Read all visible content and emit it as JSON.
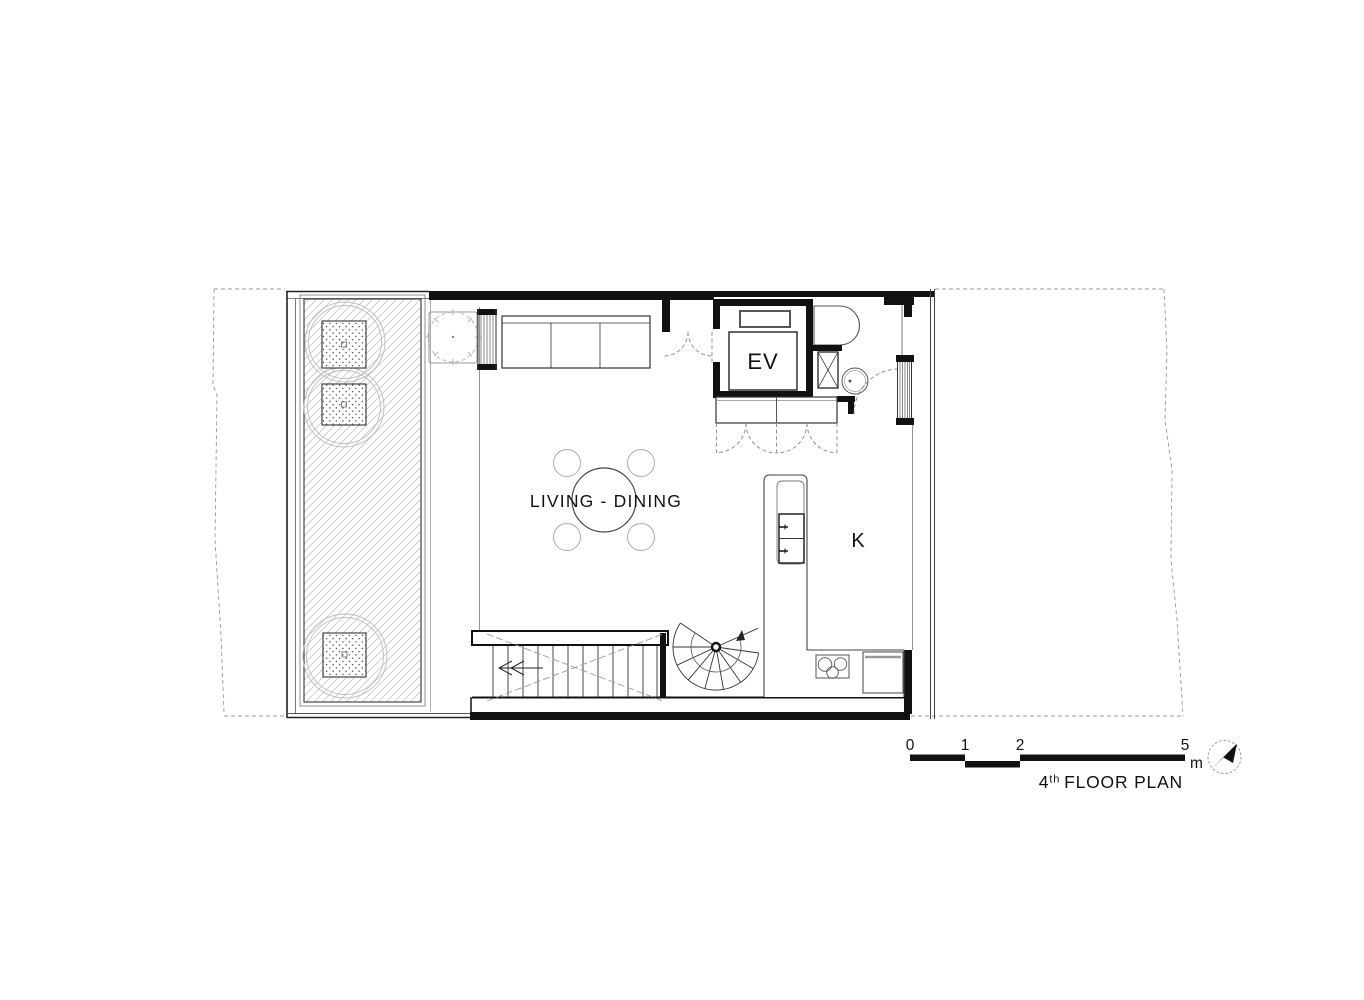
{
  "colors": {
    "ink": "#111111",
    "line_medium": "#333333",
    "line_light": "#888888",
    "hatch": "#c9c9c9",
    "paper": "#ffffff"
  },
  "labels": {
    "living_dining": "LIVING - DINING",
    "kitchen": "K",
    "elevator": "EV"
  },
  "scale_bar": {
    "ticks": [
      "0",
      "1",
      "2",
      "5"
    ],
    "unit": "m"
  },
  "title": {
    "floor_number": "4",
    "ordinal_suffix": "th",
    "text": "FLOOR PLAN"
  },
  "icons": {
    "north_arrow": "compass-needle-pointing-north-east"
  }
}
